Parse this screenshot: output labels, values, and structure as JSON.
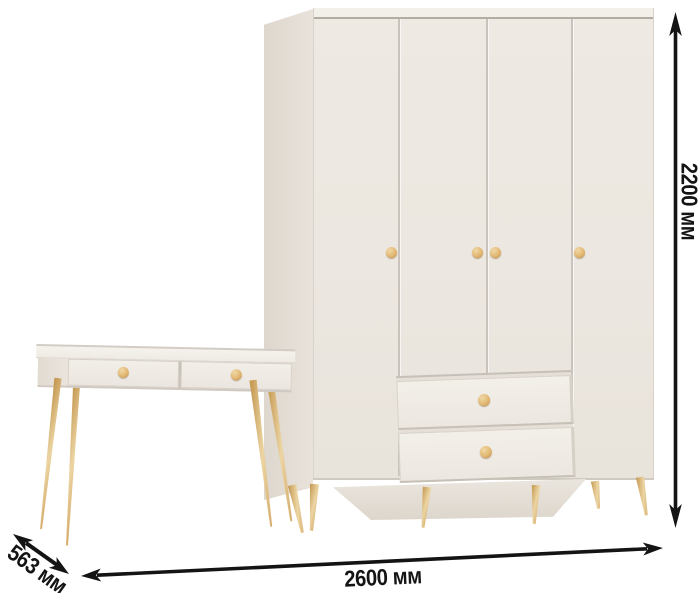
{
  "scene": {
    "type": "furniture product image with dimension arrows",
    "background_color": "#ffffff"
  },
  "furniture": {
    "wardrobe": {
      "doors": 4,
      "drawers": 2,
      "door_knobs": 4,
      "body_color": "#ece7e0",
      "side_color": "#e4ddd5",
      "knob_color": "#e2b873",
      "leg_color": "#dfb976",
      "legs_visible": 6
    },
    "console_table": {
      "drawers": 2,
      "knobs": 2,
      "body_color": "#f0ece6",
      "leg_color": "#dfb976",
      "legs_visible": 4
    }
  },
  "dimensions": {
    "line_color": "#141414",
    "width": {
      "label": "2600 мм",
      "orientation": "horizontal-bottom"
    },
    "height": {
      "label": "2200 мм",
      "orientation": "vertical-right"
    },
    "depth": {
      "label": "563 мм",
      "orientation": "diagonal-bottom-left"
    }
  }
}
